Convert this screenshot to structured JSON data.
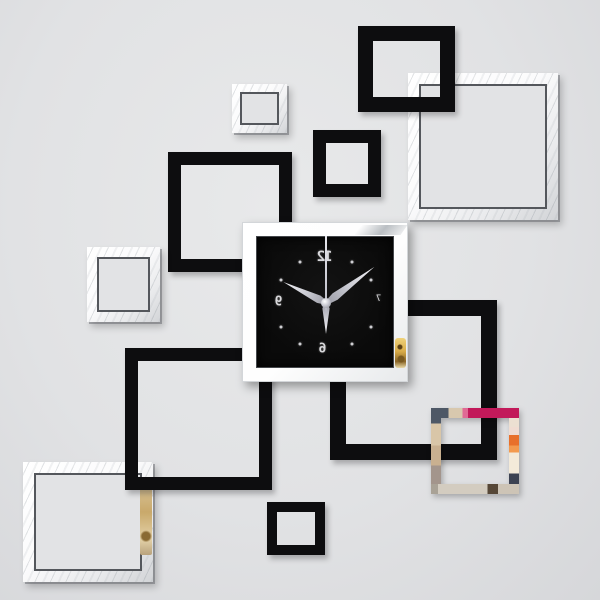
{
  "scene": {
    "alt": "DIY 3D mirror wall clock sticker set: black clock with silver frame surrounded by overlapping black and mirror square frames on a gray wall"
  },
  "colors": {
    "bg": "#e2e3e5",
    "black-frame": "#0d0d0f",
    "mirror-white": "#fbfbfc",
    "mirror-outline": "#54575c",
    "clock-face": "#0a0a0a",
    "hand-silver": "#c9cad2",
    "navy": "#4e5866",
    "magenta": "#c2195a",
    "orange": "#e8702b",
    "beige": "#d8c8ae",
    "gold": "#d8ab48"
  },
  "clock": {
    "numerals": {
      "top": "12",
      "left": "9",
      "bottom": "6",
      "right": "7"
    },
    "hands": {
      "hour_deg": -64,
      "minute_deg": 53,
      "second_deg": 0,
      "down_deg": 180
    },
    "dot_angles_deg": [
      30,
      60,
      120,
      150,
      210,
      240,
      300,
      330
    ],
    "dot_radius_x": 52,
    "dot_radius_y": 47
  },
  "frames": [
    {
      "name": "frame-mirror-top-right",
      "style": "mirror",
      "rect": {
        "x": 408,
        "y": 73,
        "w": 150,
        "h": 147
      },
      "band": 11,
      "z": 10
    },
    {
      "name": "frame-black-top",
      "style": "black",
      "rect": {
        "x": 358,
        "y": 26,
        "w": 97,
        "h": 86
      },
      "band": 15,
      "z": 12
    },
    {
      "name": "frame-mirror-top-left-small",
      "style": "mirror",
      "rect": {
        "x": 232,
        "y": 84,
        "w": 55,
        "h": 49
      },
      "band": 8,
      "z": 10
    },
    {
      "name": "frame-black-upper-middle",
      "style": "black",
      "rect": {
        "x": 313,
        "y": 130,
        "w": 68,
        "h": 67
      },
      "band": 13,
      "z": 12
    },
    {
      "name": "frame-black-left",
      "style": "black",
      "rect": {
        "x": 168,
        "y": 152,
        "w": 124,
        "h": 120
      },
      "band": 13,
      "z": 10
    },
    {
      "name": "frame-black-right",
      "style": "black",
      "rect": {
        "x": 330,
        "y": 300,
        "w": 167,
        "h": 160
      },
      "band": 16,
      "z": 10
    },
    {
      "name": "frame-mirror-left-small",
      "style": "mirror",
      "rect": {
        "x": 87,
        "y": 247,
        "w": 73,
        "h": 75
      },
      "band": 10,
      "z": 10
    },
    {
      "name": "frame-black-center-large",
      "style": "black",
      "rect": {
        "x": 125,
        "y": 348,
        "w": 147,
        "h": 142
      },
      "band": 13,
      "z": 12
    },
    {
      "name": "frame-color-right",
      "style": "color",
      "rect": {
        "x": 431,
        "y": 408,
        "w": 88,
        "h": 86
      },
      "band": 10,
      "z": 20
    },
    {
      "name": "frame-mirror-bottom-left",
      "style": "mirror",
      "rect": {
        "x": 23,
        "y": 462,
        "w": 130,
        "h": 120
      },
      "band": 11,
      "z": 10
    },
    {
      "name": "frame-black-bottom-small",
      "style": "black",
      "rect": {
        "x": 267,
        "y": 502,
        "w": 58,
        "h": 53
      },
      "band": 10,
      "z": 10
    }
  ]
}
